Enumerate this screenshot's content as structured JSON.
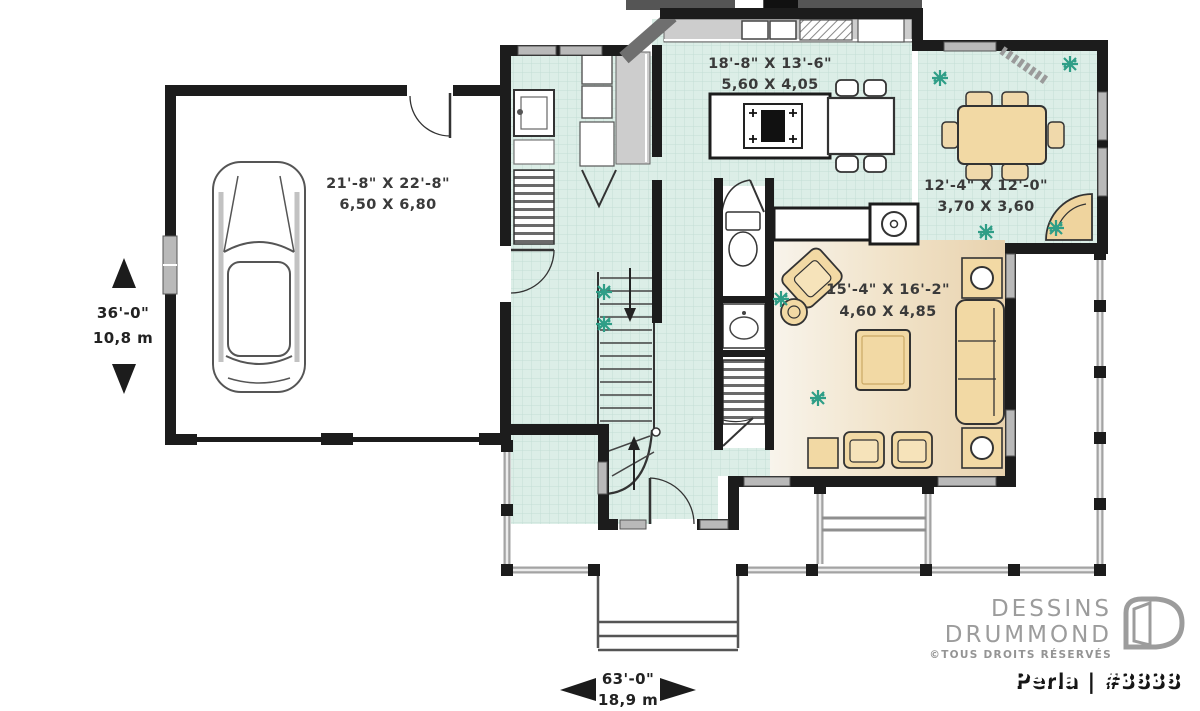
{
  "plan": {
    "rooms": {
      "garage": {
        "imperial": "21'-8\" X 22'-8\"",
        "metric": "6,50 X 6,80"
      },
      "kitchen": {
        "imperial": "18'-8\" X 13'-6\"",
        "metric": "5,60 X 4,05"
      },
      "dining": {
        "imperial": "12'-4\" X 12'-0\"",
        "metric": "3,70 X 3,60"
      },
      "living": {
        "imperial": "15'-4\" X 16'-2\"",
        "metric": "4,60 X 4,85"
      }
    },
    "overall": {
      "depth": {
        "imperial": "36'-0\"",
        "metric": "10,8 m"
      },
      "width": {
        "imperial": "63'-0\"",
        "metric": "18,9 m"
      }
    }
  },
  "branding": {
    "studio_line1": "DESSINS",
    "studio_line2": "DRUMMOND",
    "rights": "©TOUS DROITS RÉSERVÉS",
    "plan_name": "Perla | #3838"
  },
  "colors": {
    "wall": "#1c1c1c",
    "tile_floor": "#dceee7",
    "tile_grid": "#c3ded5",
    "wood_floor": "#eedcbc",
    "furniture": "#f2d9a4",
    "counter": "#cdcdcd",
    "plant": "#2f9e87",
    "railing": "#a3a3a3",
    "logo_gray": "#9c9c9c"
  },
  "symbols": [
    "car",
    "cooktop",
    "double-sink",
    "dishwasher",
    "toilet",
    "vanity-sink",
    "sofa",
    "armchair",
    "dining-table",
    "corner-cabinet",
    "staircase",
    "plant",
    "porch-railing",
    "washer-tub",
    "shelving"
  ]
}
